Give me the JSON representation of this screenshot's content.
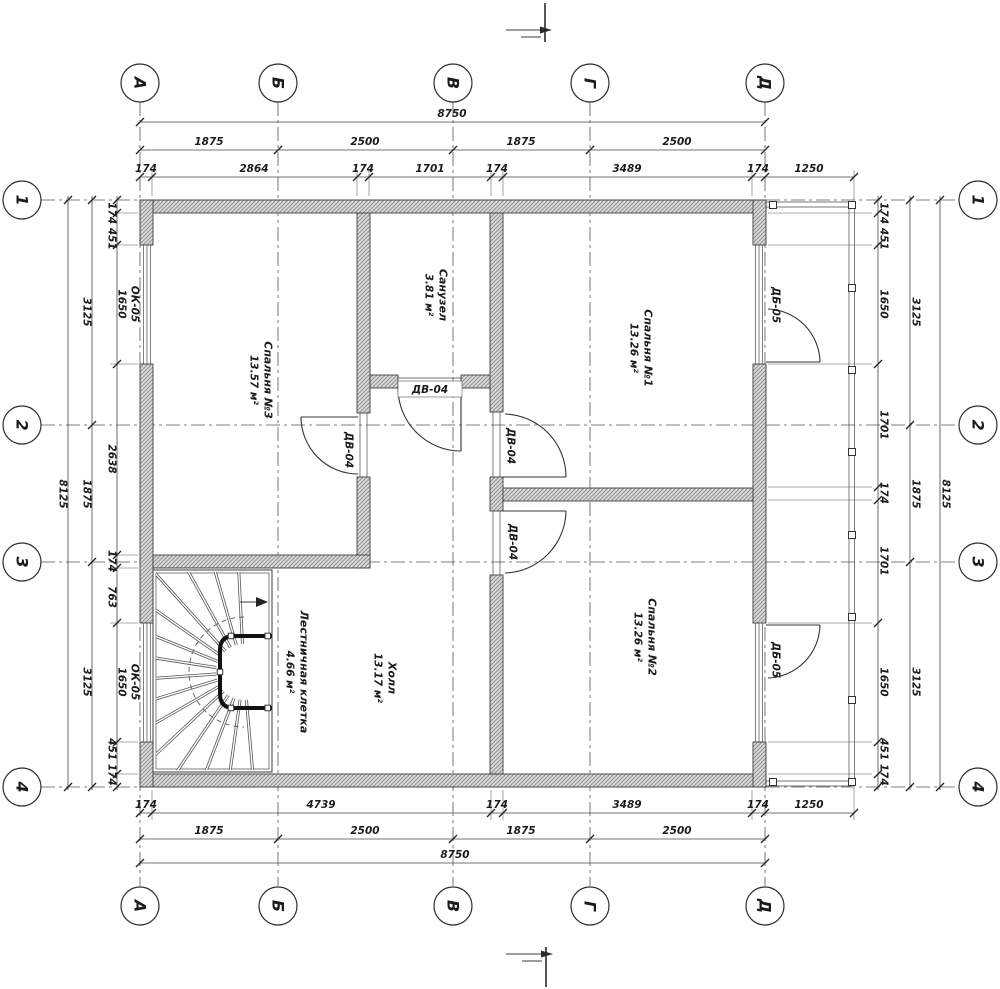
{
  "axes": {
    "cols": [
      "А",
      "Б",
      "В",
      "Г",
      "Д"
    ],
    "rows": [
      "1",
      "2",
      "3",
      "4"
    ]
  },
  "dims": {
    "top": {
      "overall": "8750",
      "row2": [
        "1875",
        "2500",
        "1875",
        "2500"
      ],
      "row3": [
        "174",
        "2864",
        "174",
        "1701",
        "174",
        "3489",
        "174",
        "1250"
      ]
    },
    "bottom": {
      "row1": [
        "174",
        "4739",
        "174",
        "3489",
        "174",
        "1250"
      ],
      "row2": [
        "1875",
        "2500",
        "1875",
        "2500"
      ],
      "overall": "8750"
    },
    "left": {
      "overall": "8125",
      "mid": [
        "3125",
        "1875",
        "3125"
      ],
      "inner": [
        "174 451",
        "1650",
        "2638",
        "174",
        "763",
        "1650",
        "451 174"
      ]
    },
    "right": {
      "overall": "8125",
      "mid": [
        "3125",
        "1875",
        "3125"
      ],
      "inner": [
        "174 451",
        "1650",
        "1701",
        "174",
        "1701",
        "1650",
        "451 174"
      ]
    }
  },
  "rooms": {
    "bedroom3": {
      "name": "Спальня №3",
      "area": "13.57 м²"
    },
    "bathroom": {
      "name": "Санузел",
      "area": "3.81 м²"
    },
    "bedroom1": {
      "name": "Спальня №1",
      "area": "13.26 м²"
    },
    "bedroom2": {
      "name": "Спальня №2",
      "area": "13.26 м²"
    },
    "hall": {
      "name": "Холл",
      "area": "13.17 м²"
    },
    "stairs": {
      "name": "Лестничная клетка",
      "area": "4.66 м²"
    }
  },
  "openings": {
    "door_interior": "ДВ-04",
    "door_balcony": "ДБ-05",
    "window": "ОК-05"
  }
}
